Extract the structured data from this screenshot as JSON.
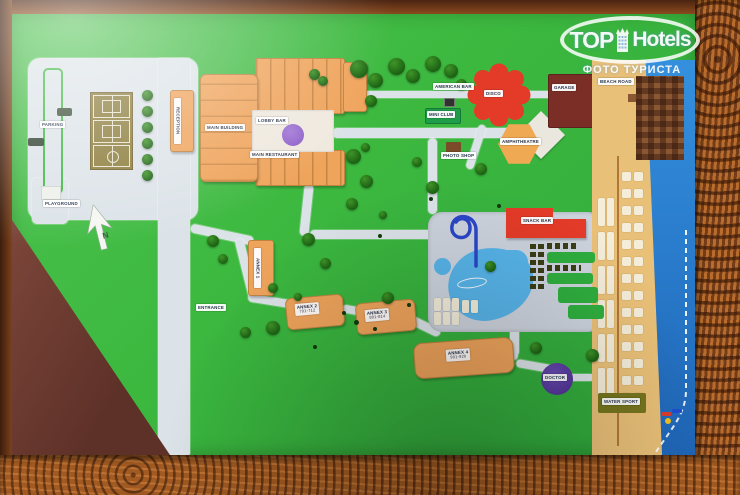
{
  "watermark": {
    "brand_top": "TOP",
    "brand_hotels": "Hotels",
    "subtitle": "ФОТО ТУРИСТА"
  },
  "map": {
    "labels": {
      "parking": "PARKING",
      "playground": "PLAYGROUND",
      "entrance": "ENTRANCE",
      "reception": "RECEPTION",
      "main_building": "MAIN BUILDING",
      "lobby_bar": "LOBBY BAR",
      "main_restaurant": "MAIN RESTAURANT",
      "american_bar": "AMERICAN BAR",
      "mini_club": "MINI CLUB",
      "disco": "DISCO",
      "garage": "GARAGE",
      "photo_shop": "PHOTO SHOP",
      "amphitheatre": "AMPHITHEATRE",
      "snack_bar": "SNACK BAR",
      "annex_1": "ANNEX 1",
      "annex_2": {
        "name": "ANNEX 2",
        "rooms": "701-712"
      },
      "annex_3": {
        "name": "ANNEX 3",
        "rooms": "801-814"
      },
      "annex_4": {
        "name": "ANNEX 4",
        "rooms": "901-920"
      },
      "doctor": "DOCTOR",
      "water_sport": "WATER SPORT",
      "beach_road": "BEACH ROAD",
      "north": "N"
    },
    "colors": {
      "frame_wood": "#a86127",
      "map_green": "#3cb83f",
      "road_gray": "#dce3e8",
      "building_orange": "#efa45c",
      "red_accent": "#e43b28",
      "garage_maroon": "#7a2e26",
      "pool_blue": "#57b4e9",
      "sea_blue": "#2b7fd2",
      "sand": "#e9c078",
      "purple": "#8a5cc4",
      "club_green": "#1f9e4a"
    }
  }
}
